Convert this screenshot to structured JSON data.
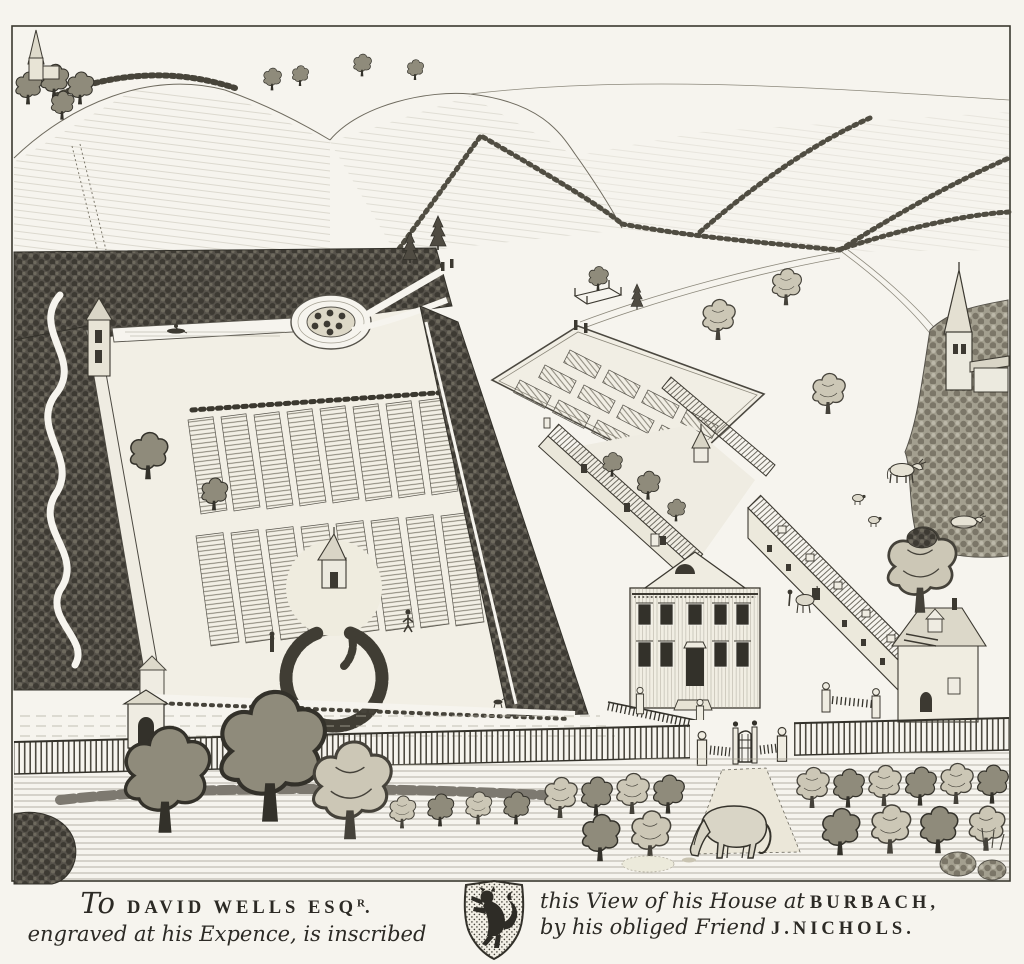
{
  "plate": {
    "label": "Vol.IV. Pl.LXVIII. p.461."
  },
  "dedication": {
    "to": "To",
    "name1": "DAVID WELLS ESQ",
    "name1_sup": "R",
    "name1_period": ".",
    "line2": "engraved at his Expence, is inscribed",
    "line3_text": "this View of his House at",
    "line3_name": "BURBACH,",
    "line4_text": "by his obliged Friend",
    "line4_name": "J.NICHOLS."
  },
  "colors": {
    "paper": "#f6f4ee",
    "ink": "#2c2a25",
    "woods": "#56524a"
  }
}
